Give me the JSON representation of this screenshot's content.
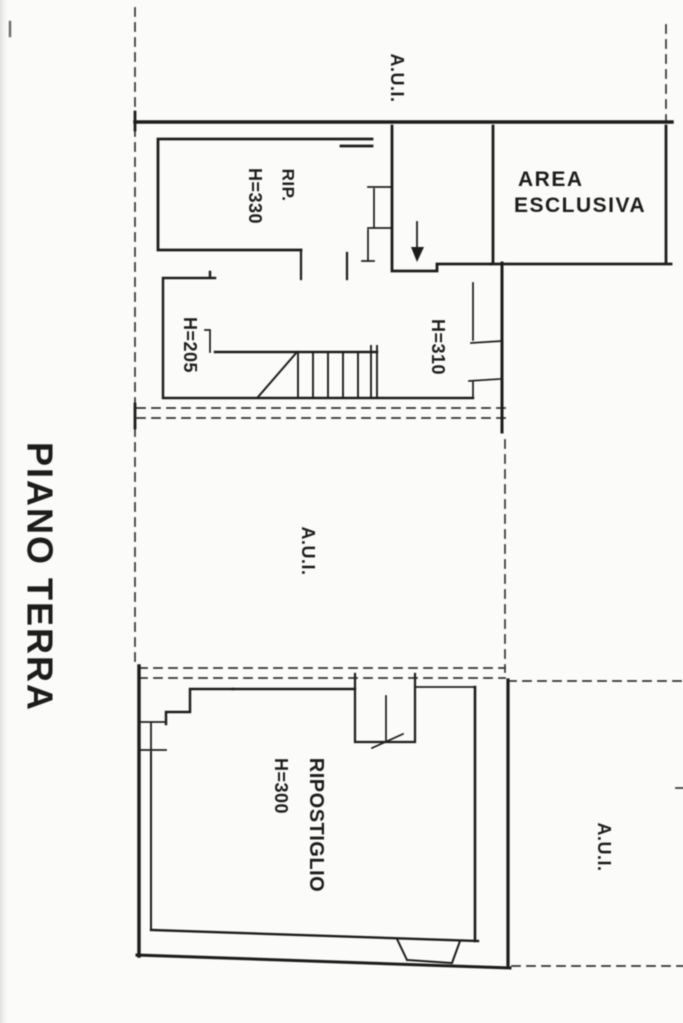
{
  "page": {
    "title": "PIANO TERRA",
    "paper_color": "#fbfbf9",
    "ink_color": "#1f1f1f",
    "boundary_line_color": "#2e2e2e"
  },
  "plan": {
    "labels": {
      "aui_top": "A.U.I.",
      "rip_abbrev": "RIP.",
      "rip_height": "H=330",
      "area_esclusiva_line1": "AREA",
      "area_esclusiva_line2": "ESCLUSIVA",
      "stair_height_low": "H=205",
      "stair_height_high": "H=310",
      "aui_middle": "A.U.I.",
      "ripostiglio": "RIPOSTIGLIO",
      "ripostiglio_height": "H=300",
      "aui_bottom_right": "A.U.I."
    }
  }
}
